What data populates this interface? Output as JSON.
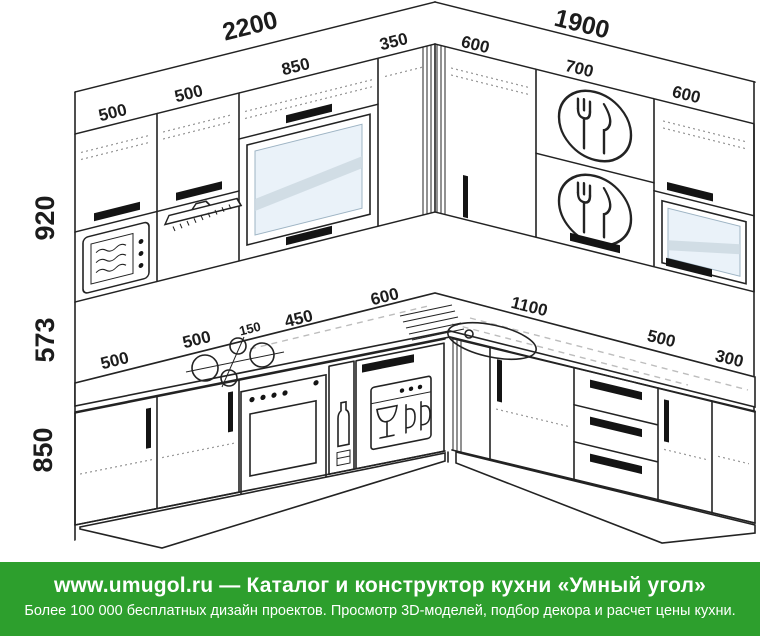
{
  "diagram": {
    "runs": {
      "left_total": "2200",
      "right_total": "1900"
    },
    "upper_left_modules": [
      "500",
      "500",
      "850",
      "350"
    ],
    "upper_right_modules": [
      "600",
      "700",
      "600"
    ],
    "height_labels": [
      "920",
      "573",
      "850"
    ],
    "base_left_modules": [
      "500",
      "500",
      "150",
      "450",
      "600"
    ],
    "base_right_modules": [
      "1100",
      "500",
      "300"
    ],
    "colors": {
      "line": "#232323",
      "glass": "#eaf2f9",
      "splash": "#a8a8a8",
      "green": "#2d9f2d"
    }
  },
  "footer": {
    "line1": "www.umugol.ru — Каталог и конструктор кухни «Умный угол»",
    "line2": "Более 100 000 бесплатных дизайн проектов. Просмотр 3D-моделей, подбор декора и расчет цены кухни."
  }
}
